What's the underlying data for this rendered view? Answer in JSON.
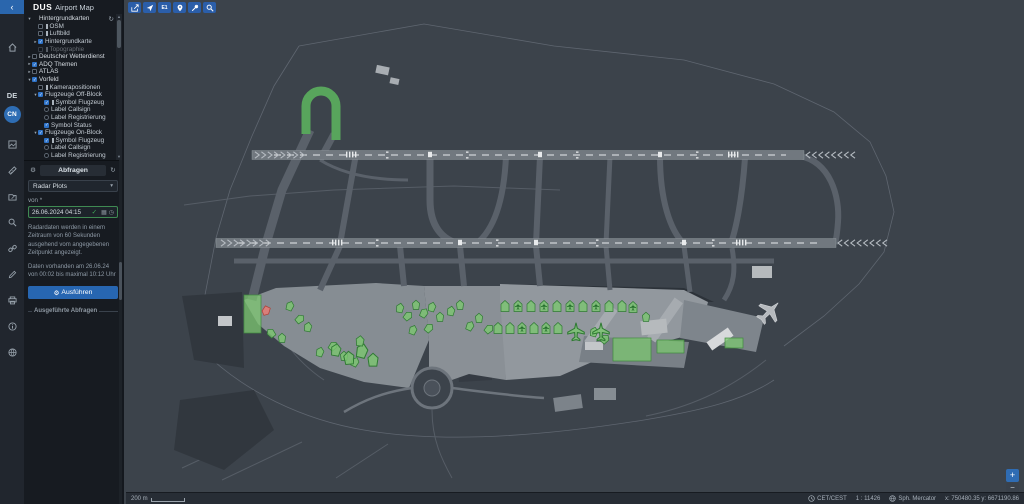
{
  "app": {
    "logo": "DUS",
    "title": "Airport Map"
  },
  "rail": {
    "collapse_glyph": "‹",
    "language": "DE",
    "user_initials": "CN",
    "icons": [
      "home-icon",
      "basemap-icon",
      "measure-icon",
      "edit-icon",
      "search-icon",
      "link-icon",
      "draw-icon",
      "print-icon",
      "info-icon",
      "help-icon"
    ]
  },
  "toolbar": {
    "buttons": [
      "share-icon",
      "locate-aircraft-icon",
      "e1-button",
      "pin-icon",
      "tools-icon",
      "search-icon"
    ],
    "e1_label": "E1"
  },
  "layer_tree": {
    "items": [
      {
        "level": 0,
        "caret": "▾",
        "cb": "none",
        "leg": false,
        "label": "Hintergrundkarten",
        "root": true
      },
      {
        "level": 1,
        "caret": "",
        "cb": "box",
        "leg": true,
        "label": "OSM"
      },
      {
        "level": 1,
        "caret": "",
        "cb": "box",
        "leg": true,
        "label": "Luftbild"
      },
      {
        "level": 1,
        "caret": "▸",
        "cb": "check",
        "leg": false,
        "label": "Hintergrundkarte"
      },
      {
        "level": 1,
        "caret": "",
        "cb": "box",
        "leg": true,
        "label": "Topographie",
        "dim": true
      },
      {
        "level": 0,
        "caret": "▸",
        "cb": "box",
        "leg": false,
        "label": "Deutscher Wetterdienst",
        "root": true
      },
      {
        "level": 0,
        "caret": "▸",
        "cb": "check",
        "leg": false,
        "label": "ADQ Themen",
        "root": true
      },
      {
        "level": 0,
        "caret": "▸",
        "cb": "box",
        "leg": false,
        "label": "ATLAS",
        "root": true
      },
      {
        "level": 0,
        "caret": "▾",
        "cb": "check",
        "leg": false,
        "label": "Vorfeld",
        "root": true
      },
      {
        "level": 1,
        "caret": "",
        "cb": "box",
        "leg": true,
        "label": "Kamerapositionen"
      },
      {
        "level": 1,
        "caret": "▾",
        "cb": "check",
        "leg": false,
        "label": "Flugzeuge Off-Block"
      },
      {
        "level": 2,
        "caret": "",
        "cb": "check",
        "leg": true,
        "label": "Symbol Flugzeug"
      },
      {
        "level": 2,
        "caret": "",
        "cb": "radio",
        "leg": false,
        "label": "Label Callsign"
      },
      {
        "level": 2,
        "caret": "",
        "cb": "radio",
        "leg": false,
        "label": "Label Registrierung"
      },
      {
        "level": 2,
        "caret": "",
        "cb": "check",
        "leg": false,
        "label": "Symbol Status"
      },
      {
        "level": 1,
        "caret": "▾",
        "cb": "check",
        "leg": false,
        "label": "Flugzeuge On-Block"
      },
      {
        "level": 2,
        "caret": "",
        "cb": "check",
        "leg": true,
        "label": "Symbol Flugzeug"
      },
      {
        "level": 2,
        "caret": "",
        "cb": "radio",
        "leg": false,
        "label": "Label Callsign"
      },
      {
        "level": 2,
        "caret": "",
        "cb": "radio",
        "leg": false,
        "label": "Label Registrierung"
      }
    ]
  },
  "query": {
    "header": "Abfragen",
    "select_value": "Radar Plots",
    "from_label": "von *",
    "datetime_value": "26.06.2024 04:15",
    "info_text": "Radardaten werden in einem Zeitraum von 60 Sekunden ausgehend vom angegebenen Zeitpunkt angezeigt.",
    "availability_text": "Daten vorhanden am 26.06.24 von 00:02 bis maximal 10:12 Uhr",
    "run_label": "Ausführen",
    "executed_label": "Ausgeführte Abfragen"
  },
  "statusbar": {
    "scale_label": "200 m",
    "timezone": "CET/CEST",
    "scale_ratio": "1 : 11426",
    "projection": "Sph. Mercator",
    "coords": "x: 750480.35 y: 6671190.86"
  },
  "map_controls": {
    "zoom_in": "+",
    "zoom_out": "−"
  },
  "colors": {
    "accent_blue": "#2e6db4",
    "aircraft_green": "#7cc770",
    "aircraft_red": "#e77d75",
    "highlight_taxiway": "#58a55c",
    "map_bg": "#3c434b",
    "runway": "#71787f",
    "apron": "#8a9096"
  },
  "map": {
    "zones": [
      {
        "x": 118,
        "y": 295,
        "w": 17,
        "h": 38
      },
      {
        "x": 487,
        "y": 338,
        "w": 38,
        "h": 23
      },
      {
        "x": 531,
        "y": 340,
        "w": 27,
        "h": 13
      },
      {
        "x": 599,
        "y": 338,
        "w": 18,
        "h": 10
      }
    ],
    "aircraft": [
      {
        "x": 140,
        "y": 311,
        "r": 205,
        "t": "b",
        "c": "r"
      },
      {
        "x": 164,
        "y": 306,
        "r": 20,
        "t": "b"
      },
      {
        "x": 174,
        "y": 319,
        "r": 50,
        "t": "b"
      },
      {
        "x": 182,
        "y": 327,
        "r": 10,
        "t": "b"
      },
      {
        "x": 156,
        "y": 338,
        "r": 0,
        "t": "b"
      },
      {
        "x": 145,
        "y": 333,
        "r": 320,
        "t": "b"
      },
      {
        "x": 194,
        "y": 352,
        "r": 15,
        "t": "b"
      },
      {
        "x": 207,
        "y": 346,
        "r": 40,
        "t": "b"
      },
      {
        "x": 218,
        "y": 356,
        "r": 0,
        "t": "b"
      },
      {
        "x": 229,
        "y": 362,
        "r": 25,
        "t": "b"
      },
      {
        "x": 210,
        "y": 350,
        "r": 10,
        "t": "b",
        "s": 1.3
      },
      {
        "x": 223,
        "y": 358,
        "r": 355,
        "t": "b",
        "s": 1.4
      },
      {
        "x": 236,
        "y": 351,
        "r": 15,
        "t": "b",
        "s": 1.5
      },
      {
        "x": 247,
        "y": 360,
        "r": 0,
        "t": "b",
        "s": 1.4
      },
      {
        "x": 234,
        "y": 341,
        "r": 5,
        "t": "b",
        "s": 1.1
      },
      {
        "x": 274,
        "y": 308,
        "r": 10,
        "t": "b"
      },
      {
        "x": 282,
        "y": 316,
        "r": 45,
        "t": "b"
      },
      {
        "x": 290,
        "y": 305,
        "r": 0,
        "t": "b"
      },
      {
        "x": 298,
        "y": 313,
        "r": 30,
        "t": "b"
      },
      {
        "x": 306,
        "y": 307,
        "r": 15,
        "t": "b"
      },
      {
        "x": 314,
        "y": 317,
        "r": 0,
        "t": "b"
      },
      {
        "x": 303,
        "y": 328,
        "r": 40,
        "t": "b"
      },
      {
        "x": 287,
        "y": 330,
        "r": 20,
        "t": "b"
      },
      {
        "x": 325,
        "y": 311,
        "r": 10,
        "t": "b"
      },
      {
        "x": 334,
        "y": 305,
        "r": 0,
        "t": "b"
      },
      {
        "x": 344,
        "y": 326,
        "r": 25,
        "t": "b"
      },
      {
        "x": 353,
        "y": 318,
        "r": 0,
        "t": "b"
      },
      {
        "x": 363,
        "y": 329,
        "r": 45,
        "t": "b"
      },
      {
        "x": 468,
        "y": 332,
        "r": 15,
        "t": "b"
      },
      {
        "x": 479,
        "y": 339,
        "r": 40,
        "t": "b"
      },
      {
        "x": 520,
        "y": 317,
        "r": 0,
        "t": "b"
      },
      {
        "x": 379,
        "y": 306,
        "t": "s"
      },
      {
        "x": 392,
        "y": 306,
        "t": "s",
        "pm": true
      },
      {
        "x": 405,
        "y": 306,
        "t": "s"
      },
      {
        "x": 418,
        "y": 306,
        "t": "s",
        "pm": true
      },
      {
        "x": 431,
        "y": 306,
        "t": "s"
      },
      {
        "x": 444,
        "y": 306,
        "t": "s",
        "pm": true
      },
      {
        "x": 457,
        "y": 306,
        "t": "s"
      },
      {
        "x": 470,
        "y": 306,
        "t": "s",
        "pm": true
      },
      {
        "x": 483,
        "y": 306,
        "t": "s"
      },
      {
        "x": 496,
        "y": 306,
        "t": "s"
      },
      {
        "x": 507,
        "y": 307,
        "t": "s",
        "pm": true
      },
      {
        "x": 372,
        "y": 328,
        "t": "s"
      },
      {
        "x": 384,
        "y": 328,
        "t": "s"
      },
      {
        "x": 396,
        "y": 328,
        "t": "s",
        "pm": true
      },
      {
        "x": 408,
        "y": 328,
        "t": "s"
      },
      {
        "x": 420,
        "y": 328,
        "t": "s",
        "pm": true
      },
      {
        "x": 432,
        "y": 328,
        "t": "s"
      },
      {
        "x": 450,
        "y": 331,
        "t": "p",
        "s": 1.5
      },
      {
        "x": 475,
        "y": 331,
        "t": "p",
        "s": 1.5
      }
    ]
  }
}
